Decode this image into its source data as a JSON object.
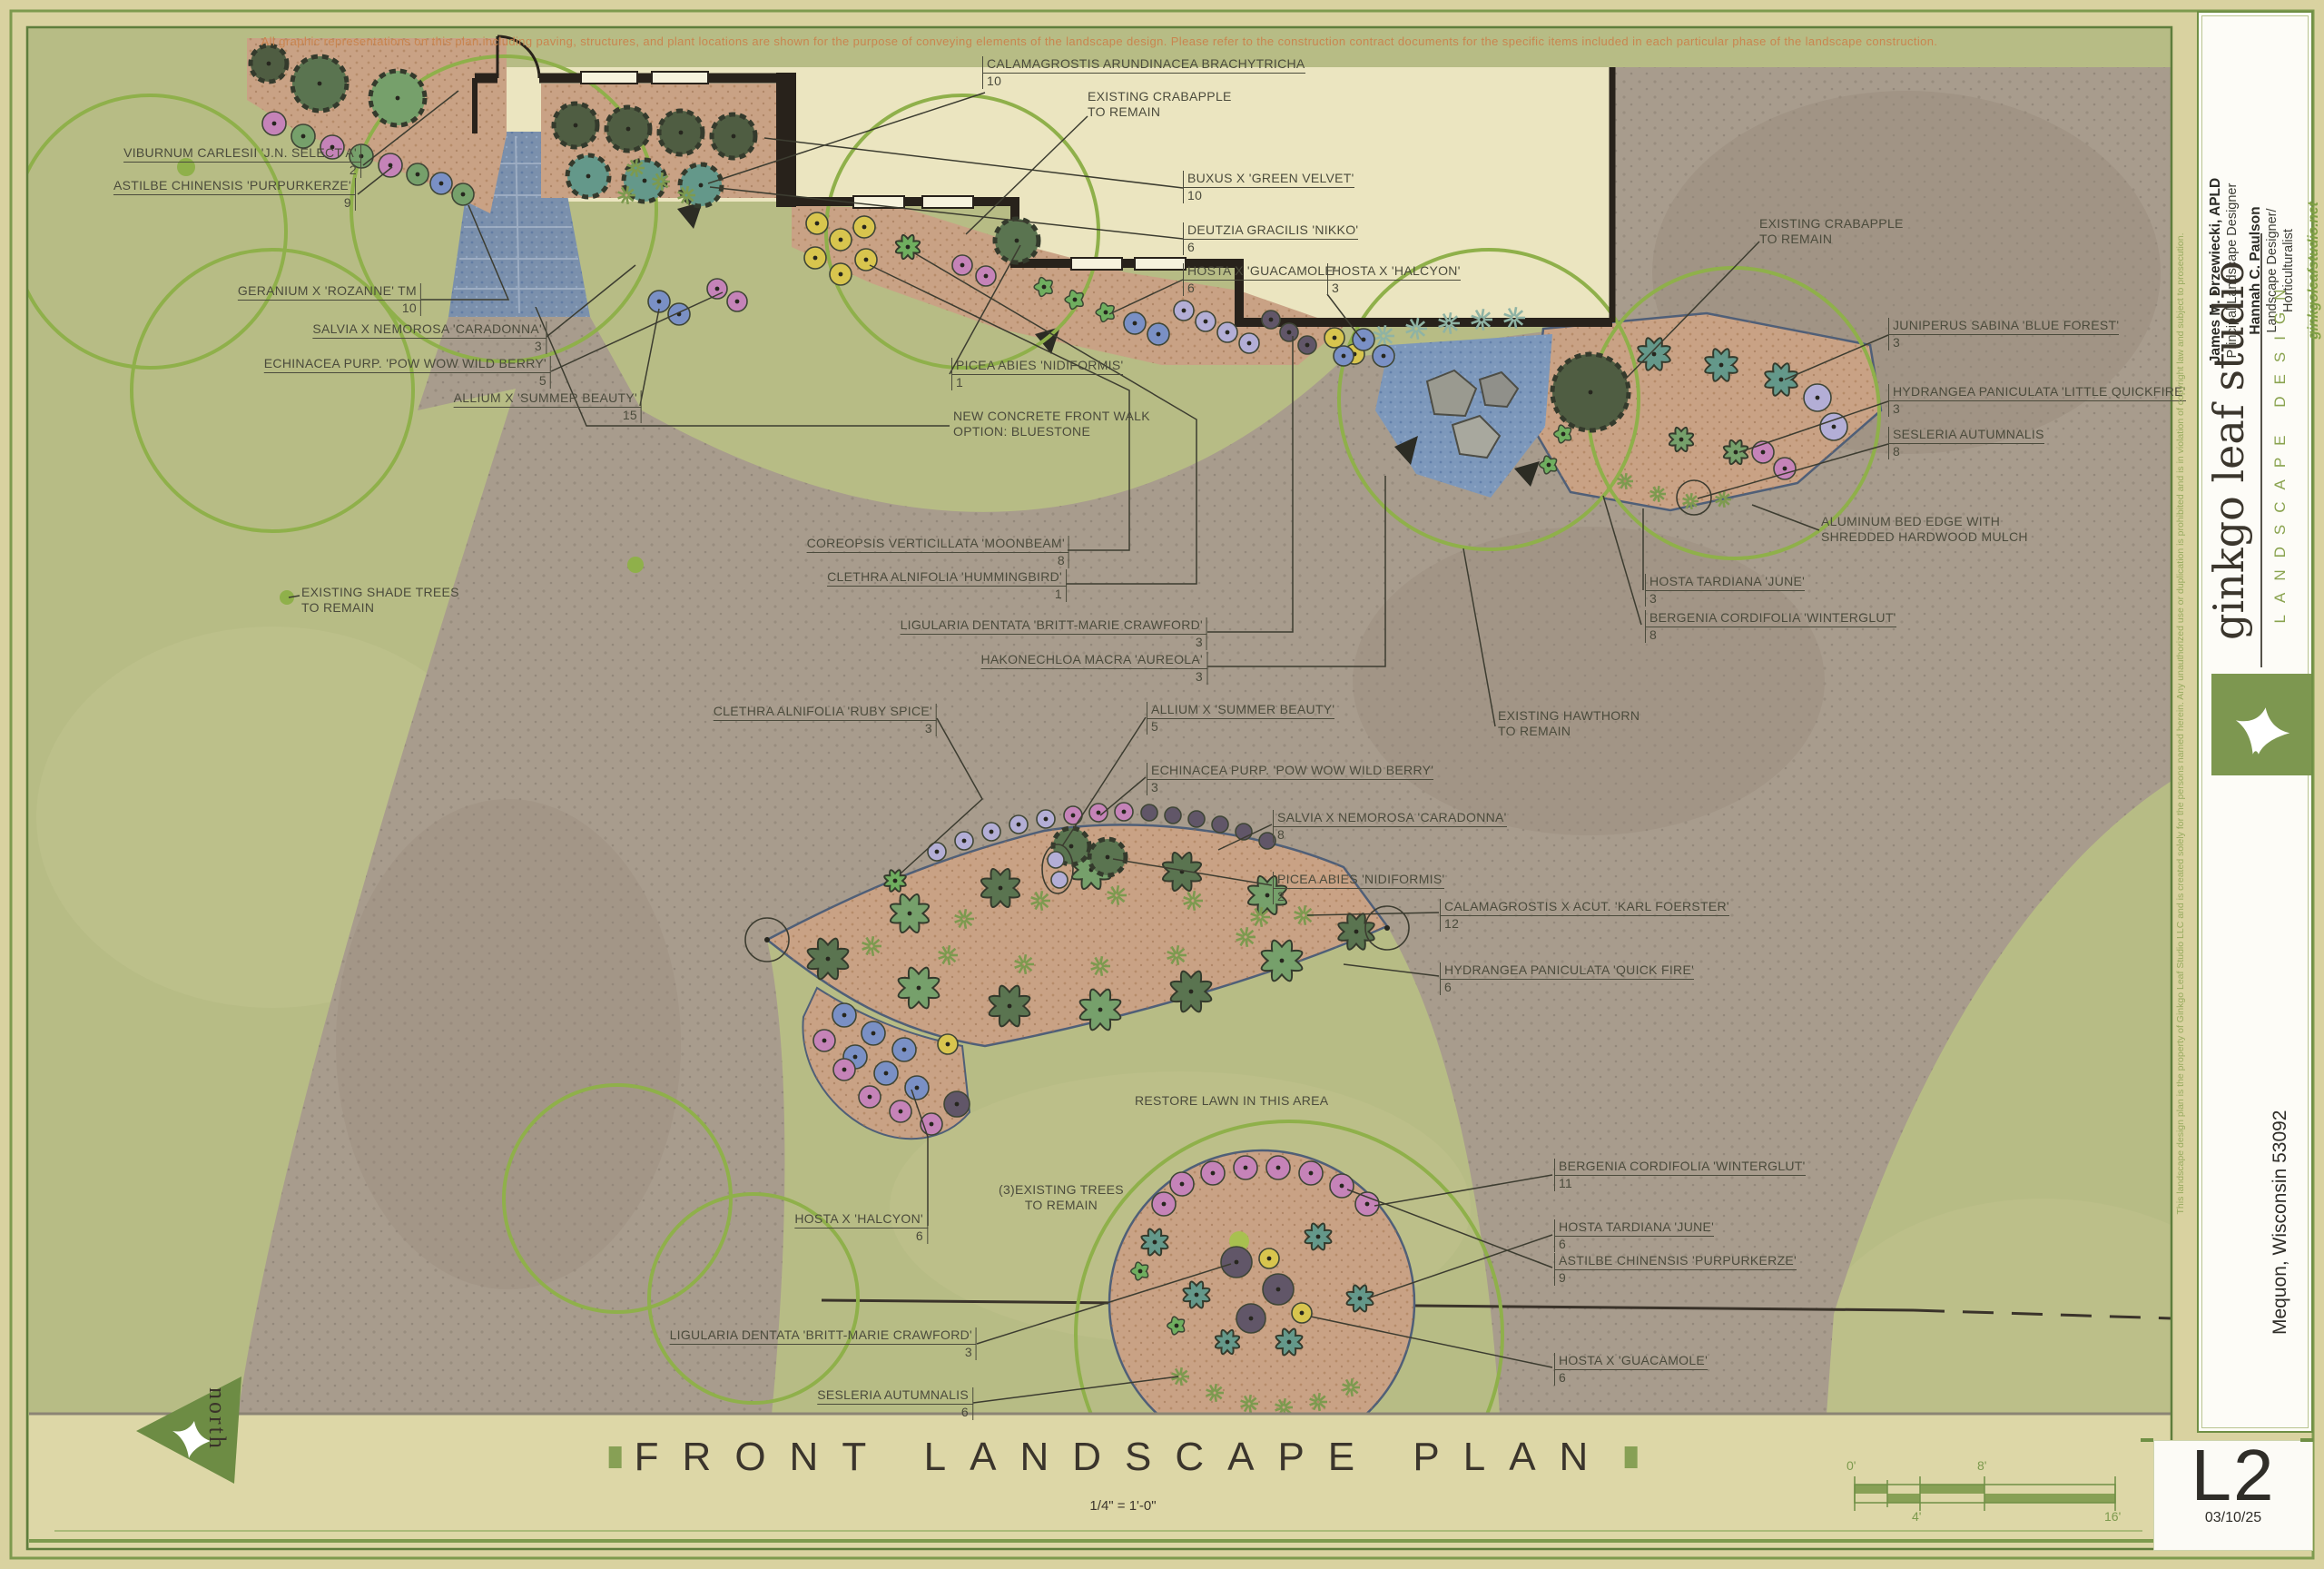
{
  "disclaimer": "All graphic representations on this plan including paving, structures, and plant locations are shown for the purpose of conveying elements of the landscape design.  Please refer to the construction contract documents for the specific items included in each particular phase of the landscape construction.",
  "title": {
    "text": "FRONT LANDSCAPE PLAN",
    "scale": "1/4\" = 1'-0\""
  },
  "north": "north",
  "scale_bar": {
    "ticks": [
      "0'",
      "4'",
      "8'",
      "16'"
    ]
  },
  "sheet": {
    "number": "L2",
    "date": "03/10/25"
  },
  "firm": {
    "studio": "ginkgo leaf studio",
    "tagline": "LANDSCAPE DESIGN",
    "website": "ginkgoleafstudio.net",
    "location": "Mequon, Wisconsin 53092",
    "copyright": "This landscape design plan is the property of Ginkgo Leaf Studio LLC and is created solely for the persons named herein.  Any unauthorized use or duplication is prohibited and is in violation of copyright law and subject to prosecution.",
    "staff": [
      {
        "name": "James M. Drzewiecki, APLD",
        "role": "Principal/Landscape Designer"
      },
      {
        "name": "Hannah C. Paulson",
        "role": "Landscape Designer/\nHorticulturalist"
      }
    ]
  },
  "plants": [
    {
      "name": "VIBURNUM CARLESII 'J.N. SELECT A'",
      "qty": "2"
    },
    {
      "name": "ASTILBE CHINENSIS 'PURPURKERZE'",
      "qty": "9"
    },
    {
      "name": "GERANIUM X 'ROZANNE' TM",
      "qty": "10"
    },
    {
      "name": "SALVIA X NEMOROSA 'CARADONNA'",
      "qty": "3"
    },
    {
      "name": "ECHINACEA PURP. 'POW WOW WILD BERRY'",
      "qty": "5"
    },
    {
      "name": "ALLIUM X 'SUMMER BEAUTY'",
      "qty": "15"
    },
    {
      "name": "EXISTING SHADE TREES\nTO REMAIN"
    },
    {
      "name": "CALAMAGROSTIS ARUNDINACEA BRACHYTRICHA",
      "qty": "10"
    },
    {
      "name": "EXISTING CRABAPPLE\nTO REMAIN"
    },
    {
      "name": "BUXUS X 'GREEN VELVET'",
      "qty": "10"
    },
    {
      "name": "DEUTZIA GRACILIS 'NIKKO'",
      "qty": "6"
    },
    {
      "name": "HOSTA X 'GUACAMOLE'",
      "qty": "6"
    },
    {
      "name": "HOSTA X 'HALCYON'",
      "qty": "3"
    },
    {
      "name": "EXISTING CRABAPPLE\nTO REMAIN"
    },
    {
      "name": "JUNIPERUS SABINA 'BLUE FOREST'",
      "qty": "3"
    },
    {
      "name": "HYDRANGEA PANICULATA 'LITTLE QUICKFIRE'",
      "qty": "3"
    },
    {
      "name": "SESLERIA AUTUMNALIS",
      "qty": "8"
    },
    {
      "name": "ALUMINUM BED EDGE WITH\nSHREDDED HARDWOOD MULCH"
    },
    {
      "name": "HOSTA TARDIANA 'JUNE'",
      "qty": "3"
    },
    {
      "name": "BERGENIA CORDIFOLIA 'WINTERGLUT'",
      "qty": "8"
    },
    {
      "name": "PICEA ABIES 'NIDIFORMIS'",
      "qty": "1"
    },
    {
      "name": "NEW CONCRETE FRONT WALK\nOPTION: BLUESTONE"
    },
    {
      "name": "COREOPSIS VERTICILLATA 'MOONBEAM'",
      "qty": "8"
    },
    {
      "name": "CLETHRA ALNIFOLIA 'HUMMINGBIRD'",
      "qty": "1"
    },
    {
      "name": "LIGULARIA DENTATA 'BRITT-MARIE CRAWFORD'",
      "qty": "3"
    },
    {
      "name": "HAKONECHLOA MACRA 'AUREOLA'",
      "qty": "3"
    },
    {
      "name": "EXISTING HAWTHORN\nTO REMAIN"
    },
    {
      "name": "CLETHRA ALNIFOLIA 'RUBY SPICE'",
      "qty": "3"
    },
    {
      "name": "ALLIUM X 'SUMMER BEAUTY'",
      "qty": "5"
    },
    {
      "name": "ECHINACEA PURP. 'POW WOW WILD BERRY'",
      "qty": "3"
    },
    {
      "name": "SALVIA X NEMOROSA 'CARADONNA'",
      "qty": "8"
    },
    {
      "name": "PICEA ABIES 'NIDIFORMIS'",
      "qty": "2"
    },
    {
      "name": "CALAMAGROSTIS X ACUT. 'KARL FOERSTER'",
      "qty": "12"
    },
    {
      "name": "HYDRANGEA PANICULATA 'QUICK FIRE'",
      "qty": "6"
    },
    {
      "name": "RESTORE LAWN IN THIS AREA"
    },
    {
      "name": "(3)EXISTING TREES\nTO REMAIN"
    },
    {
      "name": "HOSTA X 'HALCYON'",
      "qty": "6"
    },
    {
      "name": "BERGENIA CORDIFOLIA 'WINTERGLUT'",
      "qty": "11"
    },
    {
      "name": "HOSTA TARDIANA 'JUNE'",
      "qty": "6"
    },
    {
      "name": "ASTILBE CHINENSIS 'PURPURKERZE'",
      "qty": "9"
    },
    {
      "name": "HOSTA X 'GUACAMOLE'",
      "qty": "6"
    },
    {
      "name": "LIGULARIA DENTATA 'BRITT-MARIE CRAWFORD'",
      "qty": "3"
    },
    {
      "name": "SESLERIA AUTUMNALIS",
      "qty": "6"
    }
  ]
}
